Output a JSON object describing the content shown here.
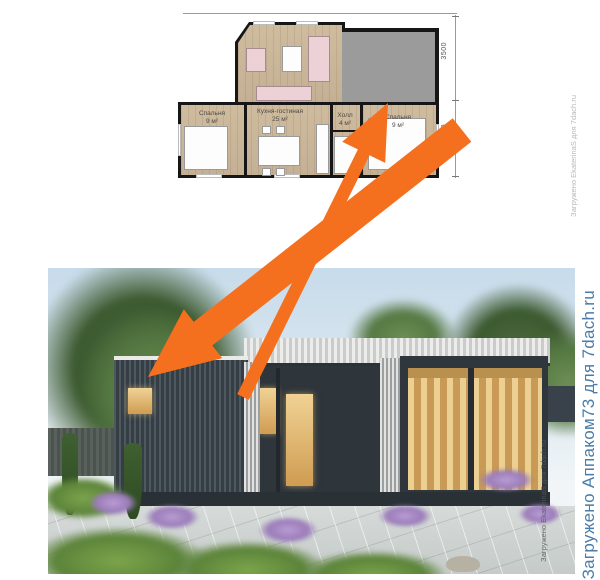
{
  "floor_plan": {
    "rooms": [
      {
        "name": "Спальня",
        "area": "9 м²"
      },
      {
        "name": "Кухня-гостиная",
        "area": "25 м²"
      },
      {
        "name": "Холл",
        "area": "4 м²"
      },
      {
        "name": "Спальня",
        "area": "9 м²"
      }
    ],
    "dimensions": {
      "upper": "3500",
      "lower": "3500"
    }
  },
  "watermarks": {
    "plan_small": "Загружено EkaterinaS для 7dach.ru",
    "photo_small": "Загружено EkaterinaS для 7dach.ru",
    "photo_large": "Загружено Аппаком73 для 7dach.ru"
  },
  "colors": {
    "arrow_orange": "#F4701F",
    "terrace_gray": "#9B9B9B",
    "plan_floor_tan": "#CBB79B",
    "watermark_blue": "#4A7CA9",
    "watermark_gray": "#B8B8B8"
  }
}
